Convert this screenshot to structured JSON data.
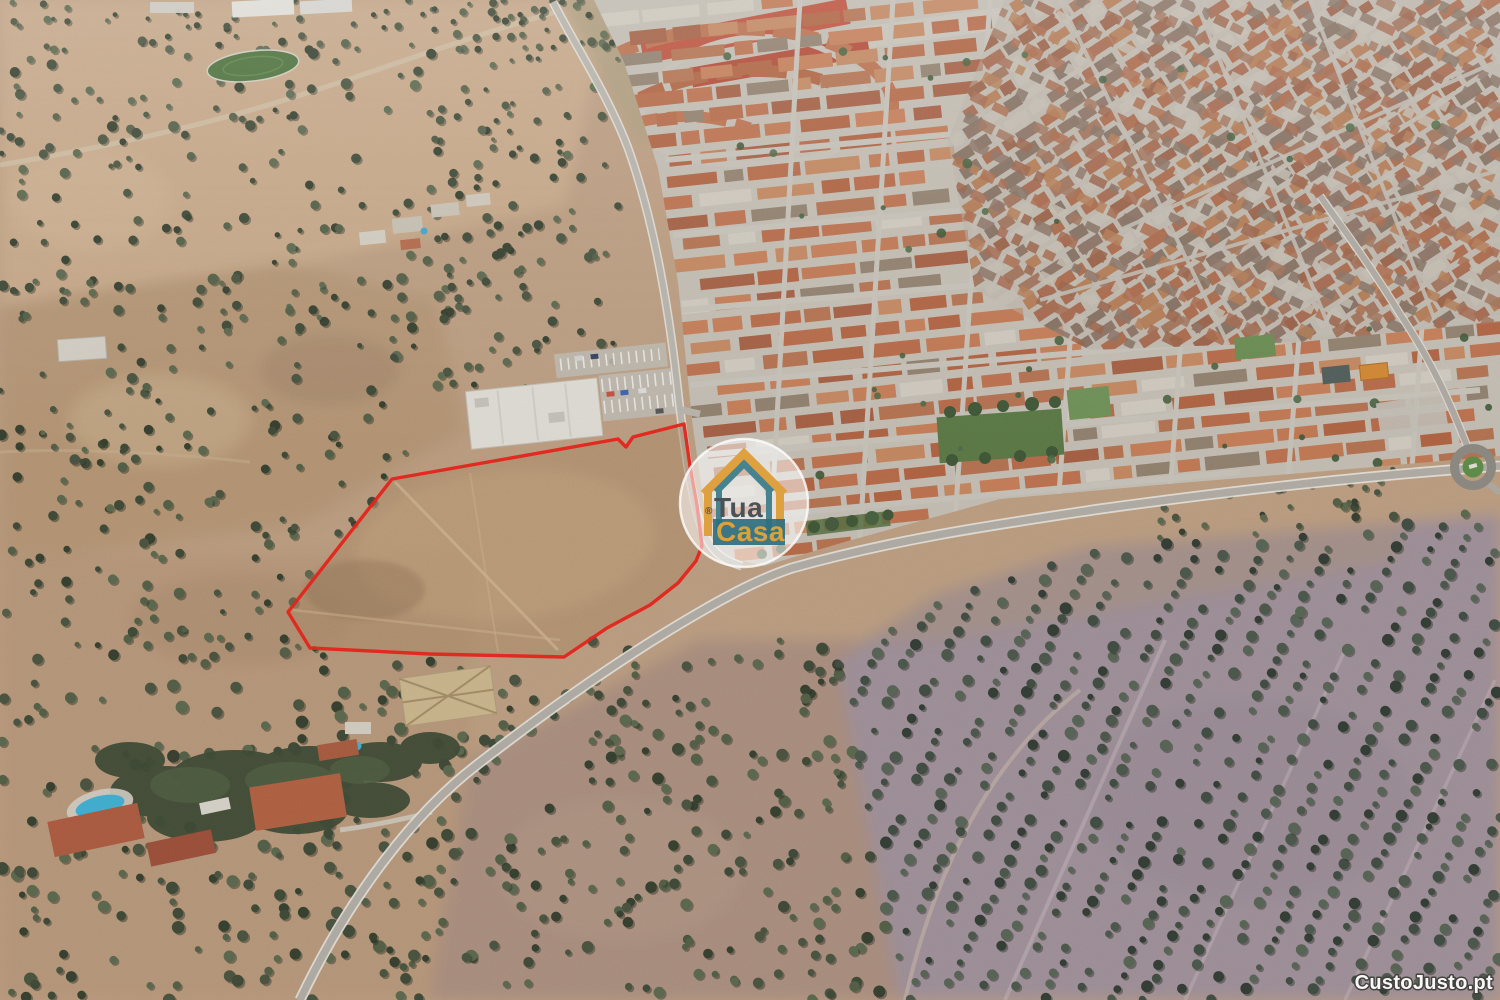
{
  "logo": {
    "registered": "®",
    "line1": "Tua",
    "line2": "Casa",
    "colors": {
      "orange": "#DFA03F",
      "teal": "#47838F",
      "banner": "#2E6F80",
      "text": "#4B5257",
      "gold": "#D9A23F",
      "circle_fill": "rgba(255,255,255,0.55)",
      "circle_edge": "rgba(255,255,255,0.78)"
    }
  },
  "site_credit": {
    "label": "CustoJusto.pt",
    "color": "#FFFFFF"
  },
  "annotation": {
    "outline_color": "#E3251D",
    "outline_points": [
      684,
      424,
      633,
      437,
      626,
      447,
      618,
      439,
      392,
      479,
      288,
      612,
      310,
      648,
      430,
      654,
      564,
      657,
      607,
      628,
      650,
      605,
      678,
      583,
      696,
      561,
      702,
      546,
      697,
      505,
      690,
      466
    ]
  }
}
